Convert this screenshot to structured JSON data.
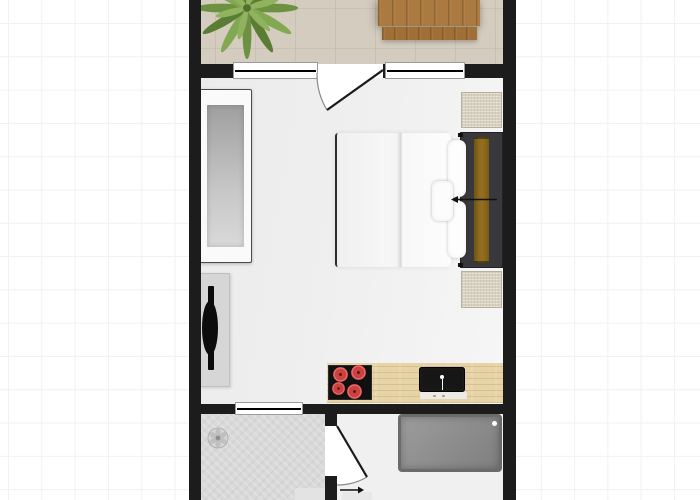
{
  "floorplan": {
    "type": "studio-apartment-floor-plan",
    "rooms": [
      {
        "name": "balcony"
      },
      {
        "name": "living-room"
      },
      {
        "name": "kitchenette"
      },
      {
        "name": "shower-room"
      },
      {
        "name": "entry-hall"
      }
    ],
    "symbols": [
      {
        "name": "palm-plant-icon"
      },
      {
        "name": "wood-table"
      },
      {
        "name": "wood-bench"
      },
      {
        "name": "sofa"
      },
      {
        "name": "tv-sideboard"
      },
      {
        "name": "tv-icon"
      },
      {
        "name": "double-bed"
      },
      {
        "name": "duvet"
      },
      {
        "name": "pillows"
      },
      {
        "name": "headboard"
      },
      {
        "name": "bed-direction-arrow-icon"
      },
      {
        "name": "bedside-mat-top"
      },
      {
        "name": "bedside-mat-bottom"
      },
      {
        "name": "kitchen-counter"
      },
      {
        "name": "cooktop-4-burners"
      },
      {
        "name": "sink"
      },
      {
        "name": "balcony-window-left"
      },
      {
        "name": "balcony-window-right"
      },
      {
        "name": "balcony-door-swing-icon"
      },
      {
        "name": "interior-window"
      },
      {
        "name": "interior-door-swing-icon"
      },
      {
        "name": "shower-drain-icon"
      },
      {
        "name": "bathtub"
      },
      {
        "name": "entrance-arrow-icon"
      },
      {
        "name": "doormats"
      }
    ]
  },
  "colors": {
    "background": "#ffffff",
    "grid": "#f1f1f1",
    "wall": "#1c1c1c",
    "balconyFloor": "#d4ccbf",
    "roomFloor": "#efefef",
    "showerFloor": "#d9d9d9",
    "entryFloor": "#f0f0f0",
    "windowFill": "#ffffff",
    "windowFrame": "#9b9b9b",
    "woodTable": "#aa7a41",
    "counterWood": "#e6d3a6",
    "cooktop": "#101010",
    "burnerRed": "#cc4040",
    "burnerDark": "#952323",
    "sinkBlack": "#161616",
    "sofaFrame": "#fafafa",
    "sofaSeatDark": "#9f9f9f",
    "sofaSeatLight": "#d9d9d9",
    "sofaOutline": "#4a4a4a",
    "tvStand": "#d6d6d6",
    "tvBlack": "#0c0c0c",
    "bedDuvet": "#f7f7f7",
    "bedFrameDark": "#39393d",
    "headboard": "#8e6b1e",
    "pillow": "#fdfdfd",
    "matBeige": "#d8d1c0",
    "matBorder": "#b7ae9c",
    "bathtubFill": "#7f7f7f",
    "bathtubBorder": "#6b6b6b",
    "plantGreenDark": "#5a7c33",
    "plantGreenMid": "#6d9140",
    "plantGreenLight": "#8fb35e",
    "arrowBlack": "#111111"
  }
}
